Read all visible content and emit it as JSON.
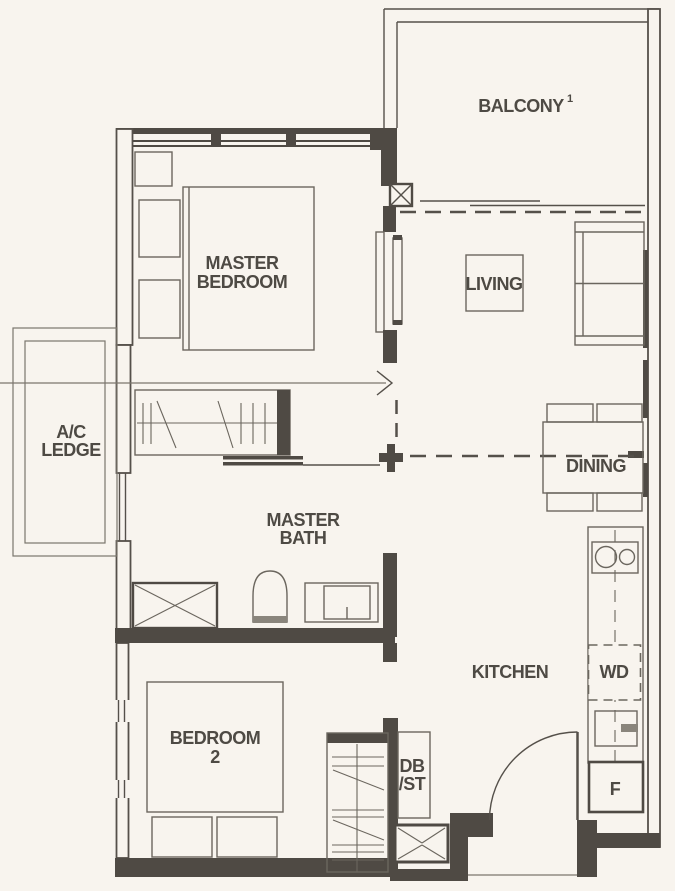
{
  "plan": {
    "type": "apartment-floor-plan",
    "colors": {
      "background": "#f8f4ee",
      "wall": "#4f4a44",
      "line": "#55504a",
      "light_line": "#7b766d",
      "label_text": "#4e4a44"
    },
    "rooms": {
      "master_bedroom": {
        "line1": "MASTER",
        "line2": "BEDROOM"
      },
      "balcony": {
        "label": "BALCONY",
        "sup": "1"
      },
      "living": {
        "label": "LIVING"
      },
      "ac_ledge": {
        "line1": "A/C",
        "line2": "LEDGE"
      },
      "dining": {
        "label": "DINING"
      },
      "master_bath": {
        "line1": "MASTER",
        "line2": "BATH"
      },
      "kitchen": {
        "label": "KITCHEN"
      },
      "bedroom_2": {
        "line1": "BEDROOM",
        "line2": "2"
      },
      "db_st": {
        "line1": "DB",
        "line2": "/ST"
      }
    },
    "appliances": {
      "washer_dryer": "WD",
      "fridge": "F"
    }
  }
}
